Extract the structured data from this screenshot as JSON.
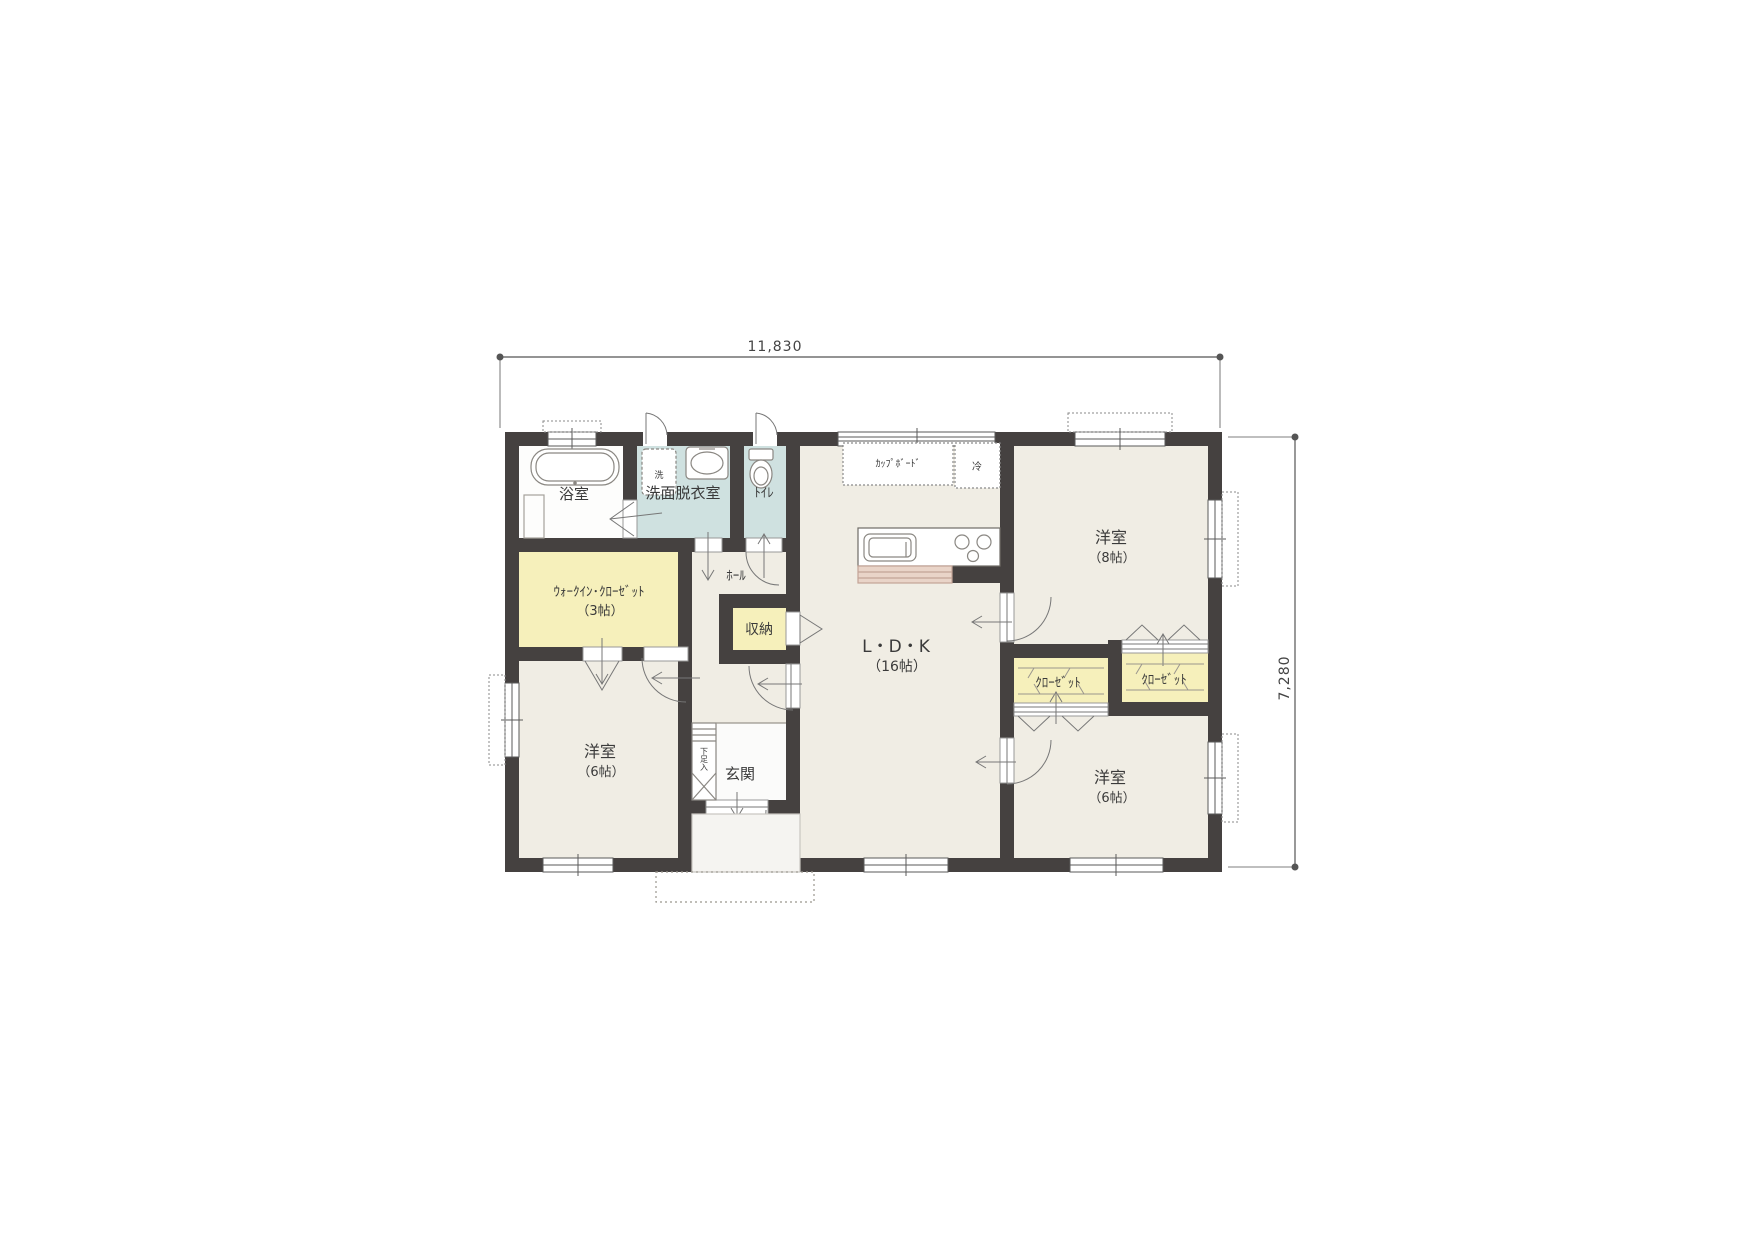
{
  "dimensions": {
    "width": "11,830",
    "height": "7,280"
  },
  "rooms": {
    "bath": {
      "label": "浴室"
    },
    "washroom": {
      "label": "洗面脱衣室"
    },
    "toilet": {
      "label": "ﾄｲﾚ"
    },
    "wic": {
      "label": "ｳｫｰｸｲﾝ･ｸﾛｰｾﾞｯﾄ",
      "size": "（3帖）"
    },
    "hall": {
      "label": "ﾎｰﾙ"
    },
    "storage": {
      "label": "収納"
    },
    "ldk": {
      "label": "L・D・K",
      "size": "（16帖）"
    },
    "bedroom8": {
      "label": "洋室",
      "size": "（8帖）"
    },
    "bedroom6_left": {
      "label": "洋室",
      "size": "（6帖）"
    },
    "bedroom6_right": {
      "label": "洋室",
      "size": "（6帖）"
    },
    "closet_left": {
      "label": "ｸﾛｰｾﾞｯﾄ"
    },
    "closet_right": {
      "label": "ｸﾛｰｾﾞｯﾄ"
    },
    "entrance": {
      "label": "玄関"
    }
  },
  "fixtures": {
    "washer": "洗",
    "fridge": "冷",
    "cupboard": "ｶｯﾌﾟﾎﾞｰﾄﾞ",
    "shoe_cabinet": "下足入"
  },
  "colors": {
    "wall": "#454140",
    "floor": "#f0ede4",
    "wet_room": "#cfe1e0",
    "closet_yellow": "#f6f0bb",
    "kitchen_front": "#e9d4c8",
    "label_text": "#3a3a3a"
  }
}
